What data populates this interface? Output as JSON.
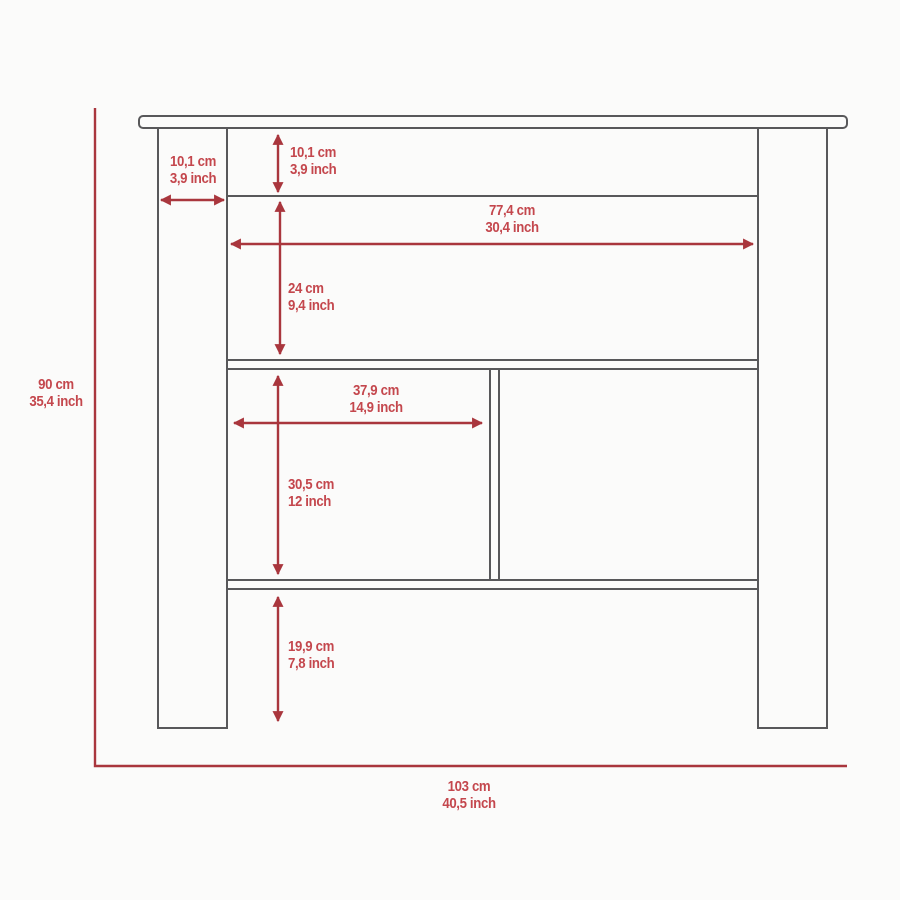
{
  "colors": {
    "accent": "#a9363d",
    "label_text": "#c4474d",
    "outline": "#58585a",
    "background": "#fbfbfa"
  },
  "diagram": {
    "overall_height": {
      "cm": "90 cm",
      "inch": "35,4 inch"
    },
    "overall_width": {
      "cm": "103 cm",
      "inch": "40,5 inch"
    },
    "leg_width": {
      "cm": "10,1 cm",
      "inch": "3,9 inch"
    },
    "apron_height": {
      "cm": "10,1 cm",
      "inch": "3,9 inch"
    },
    "shelf_span_width": {
      "cm": "77,4 cm",
      "inch": "30,4 inch"
    },
    "upper_shelf_height": {
      "cm": "24 cm",
      "inch": "9,4 inch"
    },
    "cubby_width": {
      "cm": "37,9 cm",
      "inch": "14,9 inch"
    },
    "cubby_height": {
      "cm": "30,5 cm",
      "inch": "12 inch"
    },
    "leg_clearance_height": {
      "cm": "19,9 cm",
      "inch": "7,8 inch"
    }
  }
}
